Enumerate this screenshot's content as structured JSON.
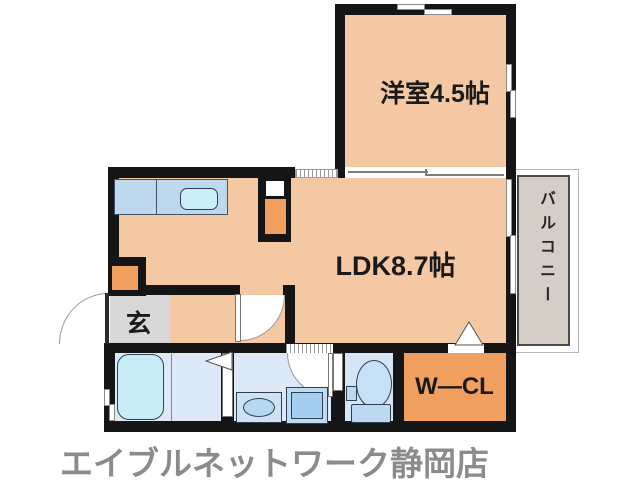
{
  "floorplan": {
    "rooms": {
      "western": {
        "label": "洋室4.5帖",
        "color": "#f3c8a3"
      },
      "ldk": {
        "label": "LDK8.7帖",
        "color": "#f3c8a3"
      },
      "balcony": {
        "label": "バルコニー",
        "color": "#d5cec6"
      },
      "genkan": {
        "label": "玄",
        "color": "#d8d8d8"
      },
      "walk_in_closet": {
        "label": "W—CL",
        "color": "#f09f5e"
      },
      "bathroom": {
        "color": "#dde9f6"
      },
      "toilet": {
        "color": "#d5e5f4"
      }
    },
    "fixtures": {
      "kitchen_counter_color": "#bed8ed",
      "sink_color": "#caf0f5",
      "bathtub_color": "#c8edf4",
      "wall_color": "#151515"
    }
  },
  "branding": {
    "store_name": "エイブルネットワーク静岡店",
    "text_color": "#8b8b8b"
  }
}
